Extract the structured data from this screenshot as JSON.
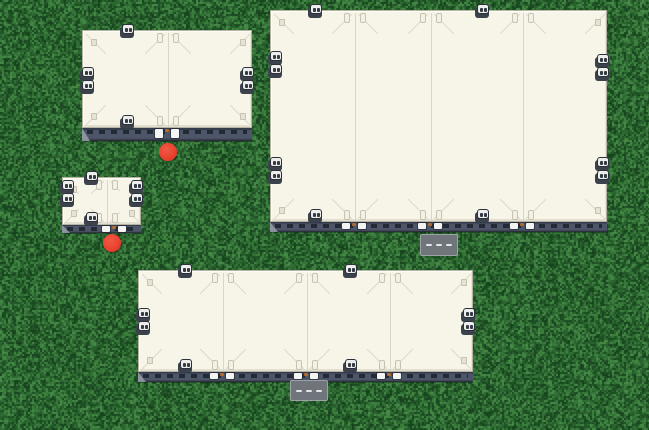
{
  "scene": {
    "width": 649,
    "height": 430,
    "terrain": {
      "name": "grass",
      "base": "#2a6630",
      "noise_colors": [
        "#16421d",
        "#1a4a21",
        "#215426",
        "#28602c",
        "#2e6a33",
        "#357538",
        "#3d813f",
        "#488c49"
      ]
    },
    "palette": {
      "roof": "#f7f4e8",
      "roof_line": "#d7d3c3",
      "roof_border": "#b7b3a4",
      "hatch_fill": "#e6e2d4",
      "pipe_fill": "#f3f0e4",
      "pipe_border": "#c7c3b2",
      "wall": "#4d5568",
      "wall_top": "#343b4b",
      "wall_bottom": "#222731",
      "window": "#232935",
      "door_post": "#f4f4f2",
      "door_accent": "#b06a33",
      "wedge": "#99a0aa",
      "vent_body": "#3c424b",
      "vent_face": "#edeeec",
      "vent_border": "#2b313b",
      "vent_slot": "#333a44",
      "marker": "#e8402e",
      "road_fill": "#70757b",
      "road_border": "#9da2a7",
      "road_dash": "#e3e5e6"
    },
    "buildings": [
      {
        "id": "building-top-left",
        "x": 82,
        "y": 30,
        "w": 170,
        "h": 98,
        "strip_h": 13,
        "dividers": [
          167
        ],
        "top_vents": [
          127
        ],
        "bottom_vents": [
          127
        ],
        "left_vent_pairs": [
          79
        ],
        "right_vent_pairs": [
          79
        ],
        "doors": [
          167
        ]
      },
      {
        "id": "building-top-right",
        "x": 270,
        "y": 10,
        "w": 337,
        "h": 212,
        "strip_h": 10,
        "dividers": [
          354,
          430,
          522
        ],
        "top_vents": [
          315,
          482
        ],
        "bottom_vents": [
          315,
          482
        ],
        "left_vent_pairs": [
          63,
          169
        ],
        "right_vent_pairs": [
          66,
          169
        ],
        "doors": [
          354,
          430,
          522
        ]
      },
      {
        "id": "building-small-left",
        "x": 62,
        "y": 177,
        "w": 79,
        "h": 48,
        "strip_h": 8,
        "dividers": [
          106
        ],
        "top_vents": [
          91
        ],
        "bottom_vents": [
          91
        ],
        "left_vent_pairs": [
          192
        ],
        "right_vent_pairs": [
          192
        ],
        "doors": [
          114
        ]
      },
      {
        "id": "building-bottom",
        "x": 138,
        "y": 270,
        "w": 335,
        "h": 102,
        "strip_h": 10,
        "dividers": [
          222,
          306,
          389
        ],
        "top_vents": [
          185,
          350
        ],
        "bottom_vents": [
          185,
          350
        ],
        "left_vent_pairs": [
          320
        ],
        "right_vent_pairs": [
          320
        ],
        "doors": [
          222,
          306,
          389
        ]
      }
    ],
    "markers": [
      {
        "id": "marker-building-top-left",
        "x": 168,
        "y": 152,
        "r": 9
      },
      {
        "id": "marker-building-small-left",
        "x": 112,
        "y": 243,
        "r": 9
      }
    ],
    "roads": [
      {
        "id": "road-segment-top-right",
        "x": 420,
        "y": 234,
        "w": 38,
        "h": 22,
        "dashes": 3
      },
      {
        "id": "road-segment-bottom",
        "x": 290,
        "y": 380,
        "w": 38,
        "h": 21,
        "dashes": 3
      }
    ]
  }
}
